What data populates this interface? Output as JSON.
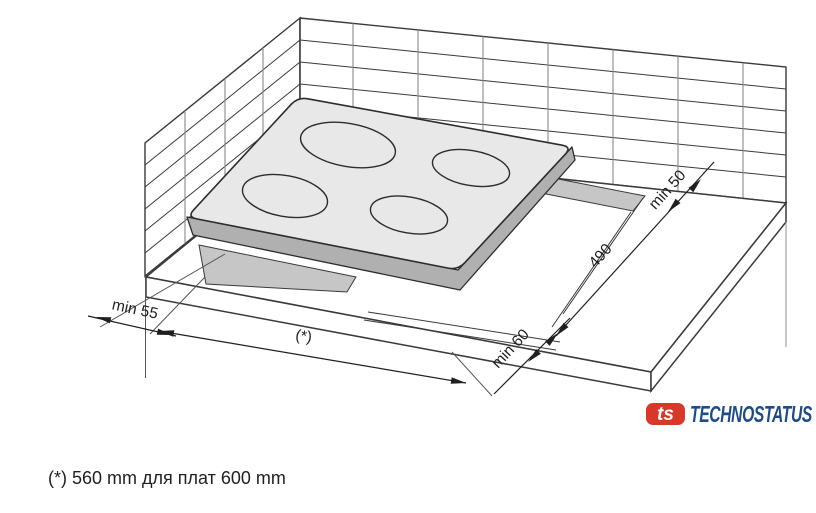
{
  "diagram": {
    "labels": {
      "min50": "min 50",
      "depth": "490",
      "min60": "min 60",
      "min55": "min 55",
      "width_ref": "(*)"
    },
    "footnote": "(*) 560 mm для плат 600 mm",
    "logo": {
      "mark": "ts",
      "name": "TECHNOSTATUS"
    },
    "colors": {
      "glass": "#e8e8e8",
      "skirt": "#b0b0b0",
      "cutout_edge": "#c6c6c6",
      "outline": "#3a3a3a",
      "logo_red": "#d8382a",
      "logo_blue": "#1e4b8a"
    }
  }
}
